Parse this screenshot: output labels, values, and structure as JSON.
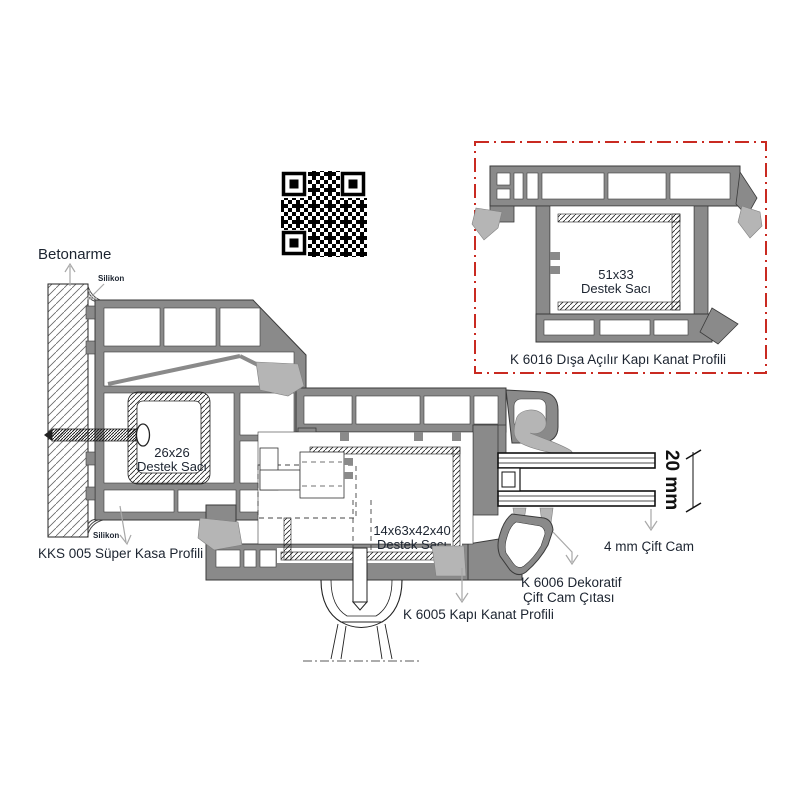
{
  "colors": {
    "profile_gray": "#8a8a8a",
    "gasket_gray": "#b5b5b5",
    "detail_box_red": "#c92a21",
    "label_color": "#1c2430"
  },
  "labels": {
    "betonarme": "Betonarme",
    "silikon_top": "Silikon",
    "silikon_bottom": "Silikon",
    "frame_profile": "KKS 005 Süper Kasa Profili",
    "steel_26_line1": "26x26",
    "steel_26_line2": "Destek Sacı",
    "steel_14_line1": "14x63x42x40",
    "steel_14_line2": "Destek Sacı",
    "sash_profile": "K 6005 Kapı Kanat Profili",
    "bead_line1": "K 6006 Dekoratif",
    "bead_line2": "Çift Cam Çıtası",
    "glazing": "4 mm Çift Cam",
    "glass_dimension": "20 mm"
  },
  "detail_box": {
    "steel_51_line1": "51x33",
    "steel_51_line2": "Destek Sacı",
    "caption": "K 6016 Dışa Açılır Kapı Kanat Profili"
  },
  "icons": {
    "qr_code": "qr-code"
  }
}
